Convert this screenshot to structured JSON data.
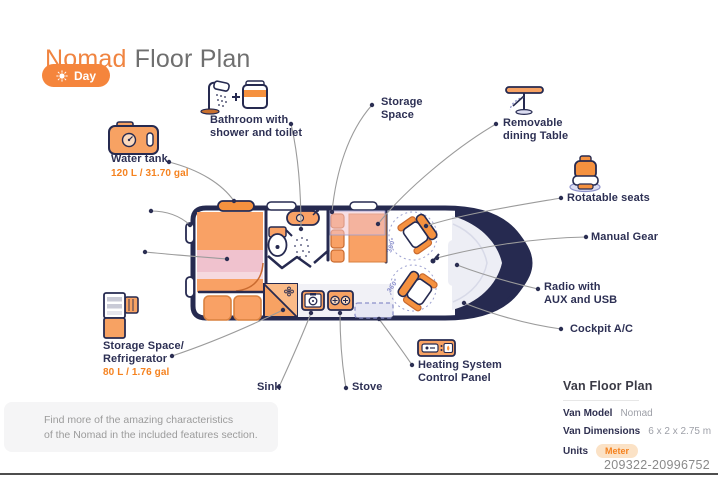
{
  "header": {
    "title_accent": "Nomad",
    "title_rest": "Floor Plan",
    "mode_button": {
      "label": "Day",
      "icon": "sun-icon"
    }
  },
  "callouts": {
    "water_tank": {
      "line1": "Water tank",
      "value": "120 L / 31.70 gal"
    },
    "bathroom": {
      "line1": "Bathroom with",
      "line2": "shower and toilet"
    },
    "storage_space": {
      "line1": "Storage",
      "line2": "Space"
    },
    "dining_table": {
      "line1": "Removable",
      "line2": "dining Table"
    },
    "rotatable_seats": {
      "line1": "Rotatable seats"
    },
    "manual_gear": {
      "line1": "Manual Gear"
    },
    "radio": {
      "line1": "Radio with",
      "line2": "AUX and USB"
    },
    "cockpit_ac": {
      "line1": "Cockpit A/C"
    },
    "heating": {
      "line1": "Heating System",
      "line2": "Control Panel"
    },
    "sink": {
      "line1": "Sink"
    },
    "stove": {
      "line1": "Stove"
    },
    "fridge": {
      "line1": "Storage Space/",
      "line2": "Refrigerator",
      "value": "80 L / 1.76 gal"
    }
  },
  "van": {
    "rotation_badge": "360°"
  },
  "note": {
    "line1": "Find more of the amazing characteristics",
    "line2": "of the Nomad in the included features section."
  },
  "info_panel": {
    "title": "Van Floor Plan",
    "rows": [
      {
        "label": "Van Model",
        "value": "Nomad"
      },
      {
        "label": "Van Dimensions",
        "value": "6 x 2 x 2.75 m"
      },
      {
        "label": "Units",
        "value": "Meter"
      }
    ]
  },
  "footer": {
    "code": "209322-20996752"
  },
  "colors": {
    "accent_orange": "#F5822B",
    "navy": "#262A50",
    "furniture_orange": "#F7A263",
    "pink": "#F0C2CE",
    "lavender": "#DCDDF2",
    "label_text": "#2D3054",
    "muted_text": "#9B9B9B"
  }
}
